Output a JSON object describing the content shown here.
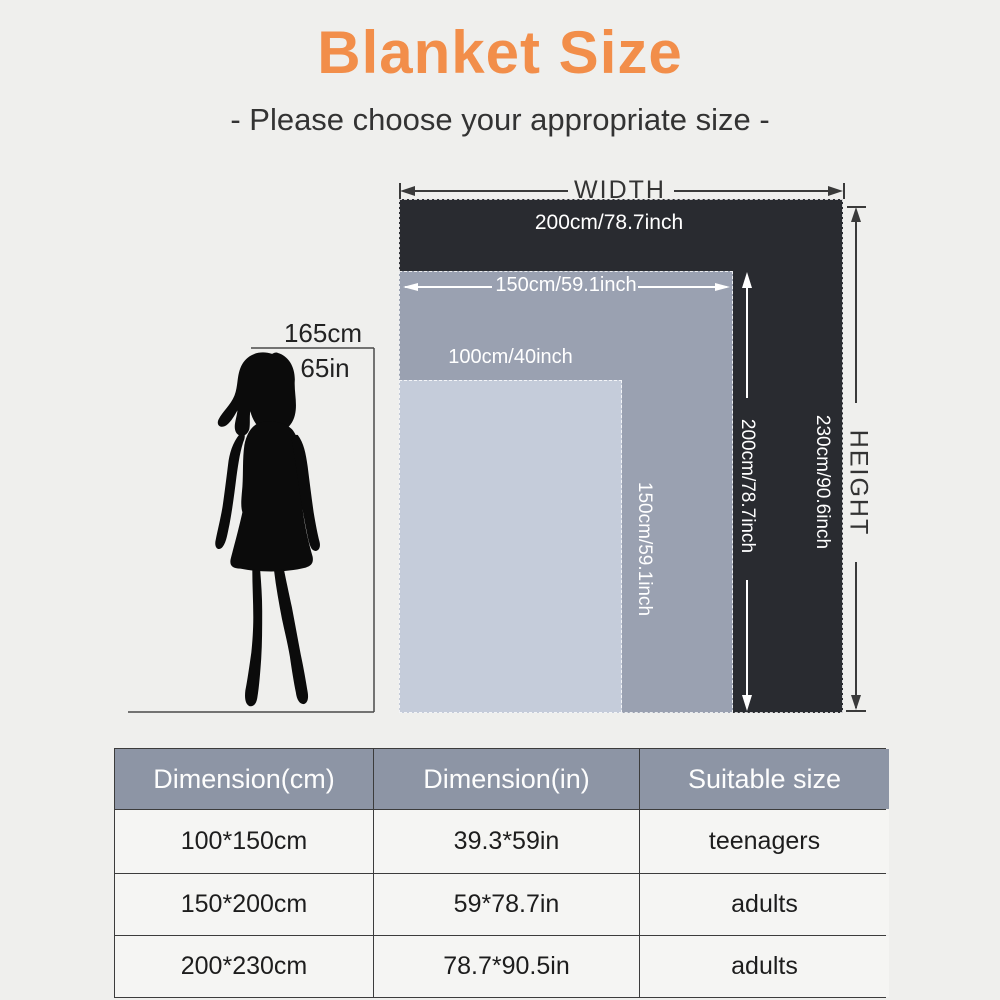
{
  "title": "Blanket Size",
  "subtitle": "- Please choose your appropriate size -",
  "colors": {
    "accent_orange": "#f28e4a",
    "blanket_200_fill": "#292b30",
    "blanket_150_fill": "#9aa1b1",
    "blanket_100_fill": "#c5ccda",
    "table_header_bg": "#8d95a5",
    "page_bg": "#efefed"
  },
  "diagram": {
    "axis_width": "WIDTH",
    "axis_height": "HEIGHT",
    "blankets": [
      {
        "name": "200x230",
        "width_label": "200cm/78.7inch",
        "height_label": "230cm/90.6inch"
      },
      {
        "name": "150x200",
        "width_label": "150cm/59.1inch",
        "height_label": "200cm/78.7inch"
      },
      {
        "name": "100x150",
        "width_label": "100cm/40inch",
        "height_label": "150cm/59.1inch"
      }
    ],
    "person": {
      "height_cm": "165cm",
      "height_in": "65in"
    }
  },
  "table": {
    "headers": [
      "Dimension(cm)",
      "Dimension(in)",
      "Suitable size"
    ],
    "rows": [
      [
        "100*150cm",
        "39.3*59in",
        "teenagers"
      ],
      [
        "150*200cm",
        "59*78.7in",
        "adults"
      ],
      [
        "200*230cm",
        "78.7*90.5in",
        "adults"
      ]
    ]
  }
}
